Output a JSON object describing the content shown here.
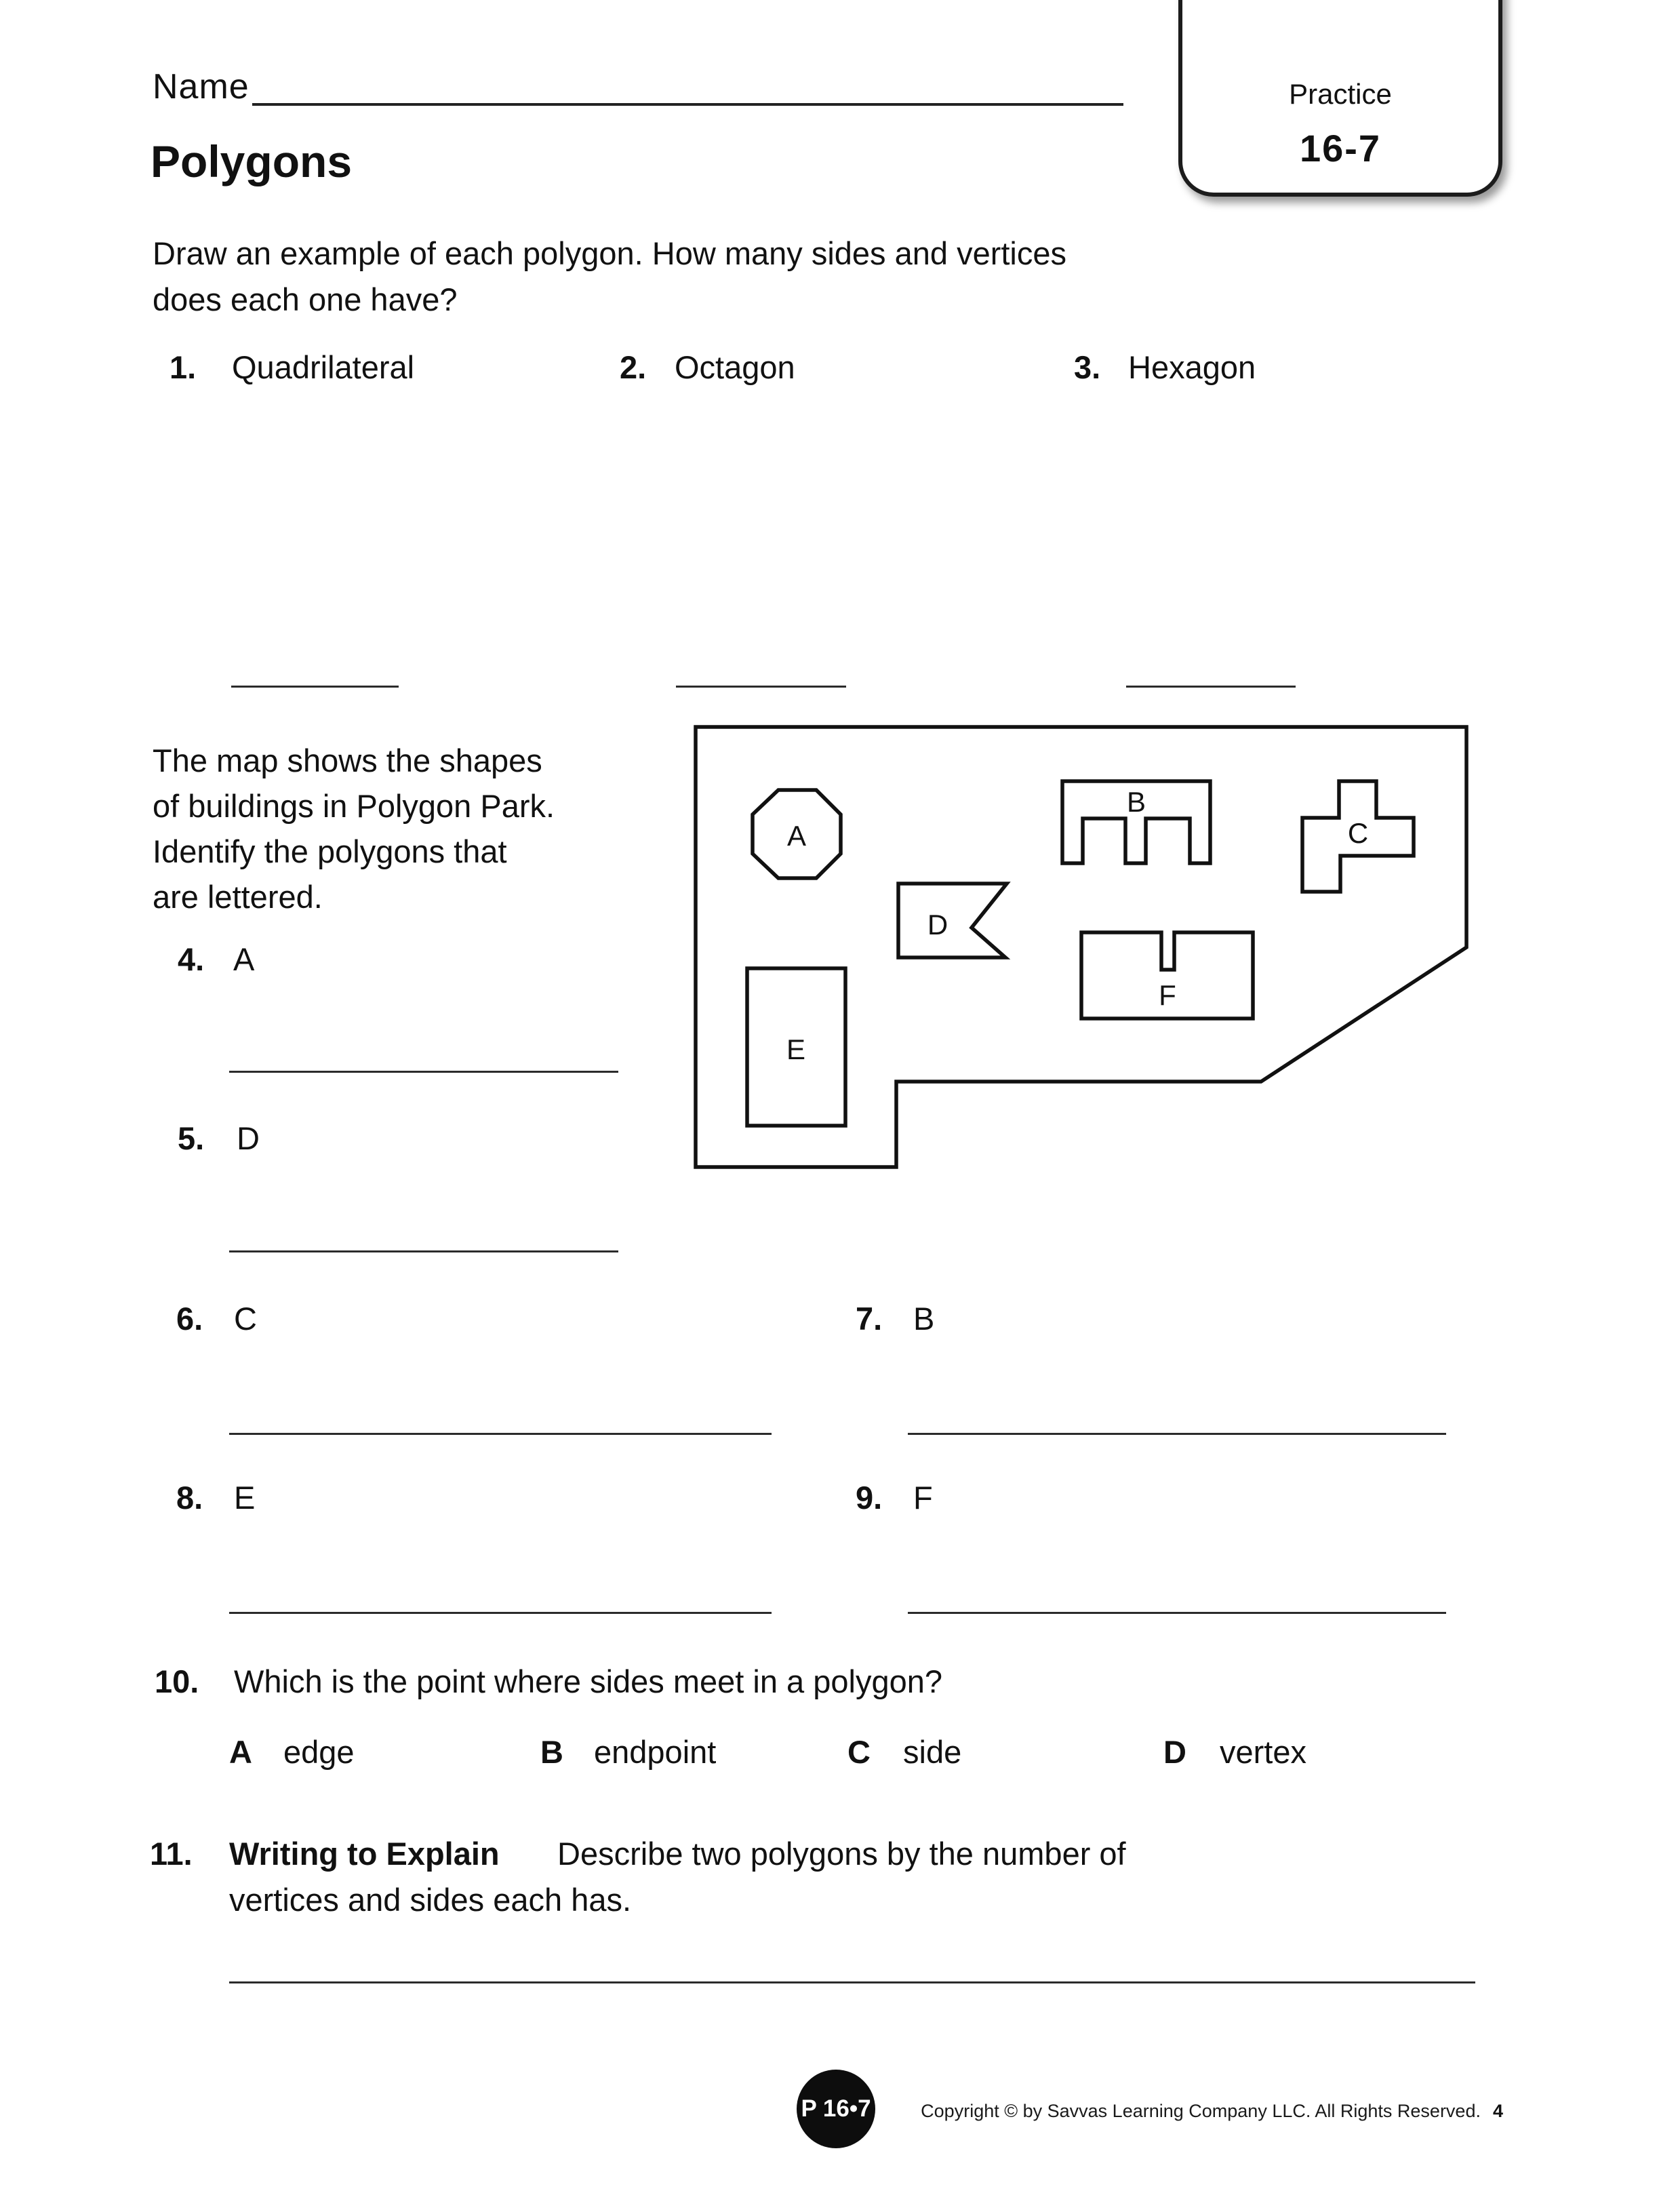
{
  "header": {
    "name_label": "Name",
    "badge": {
      "line1": "Practice",
      "line2": "16-7"
    },
    "title": "Polygons"
  },
  "intro": {
    "line1": "Draw an example of each polygon. How many sides and vertices",
    "line2": "does each one have?"
  },
  "draw_items": [
    {
      "num": "1.",
      "label": "Quadrilateral"
    },
    {
      "num": "2.",
      "label": "Octagon"
    },
    {
      "num": "3.",
      "label": "Hexagon"
    }
  ],
  "map_section": {
    "desc_lines": [
      "The map shows the shapes",
      "of buildings in Polygon Park.",
      "Identify the polygons that",
      "are lettered."
    ],
    "labels": {
      "a": "A",
      "b": "B",
      "c": "C",
      "d": "D",
      "e": "E",
      "f": "F"
    }
  },
  "identify_items": [
    {
      "num": "4.",
      "label": "A"
    },
    {
      "num": "5.",
      "label": "D"
    },
    {
      "num": "6.",
      "label": "C"
    },
    {
      "num": "7.",
      "label": "B"
    },
    {
      "num": "8.",
      "label": "E"
    },
    {
      "num": "9.",
      "label": "F"
    }
  ],
  "q10": {
    "num": "10.",
    "text": "Which is the point where sides meet in a polygon?",
    "options": [
      {
        "letter": "A",
        "text": "edge"
      },
      {
        "letter": "B",
        "text": "endpoint"
      },
      {
        "letter": "C",
        "text": "side"
      },
      {
        "letter": "D",
        "text": "vertex"
      }
    ]
  },
  "q11": {
    "num": "11.",
    "bold_lead": "Writing to Explain",
    "line1_rest": "Describe two polygons by the number of",
    "line2": "vertices and sides each has."
  },
  "footer": {
    "badge": "P 16•7",
    "copyright": "Copyright © by Savvas Learning Company LLC. All Rights Reserved.",
    "page": "4"
  }
}
